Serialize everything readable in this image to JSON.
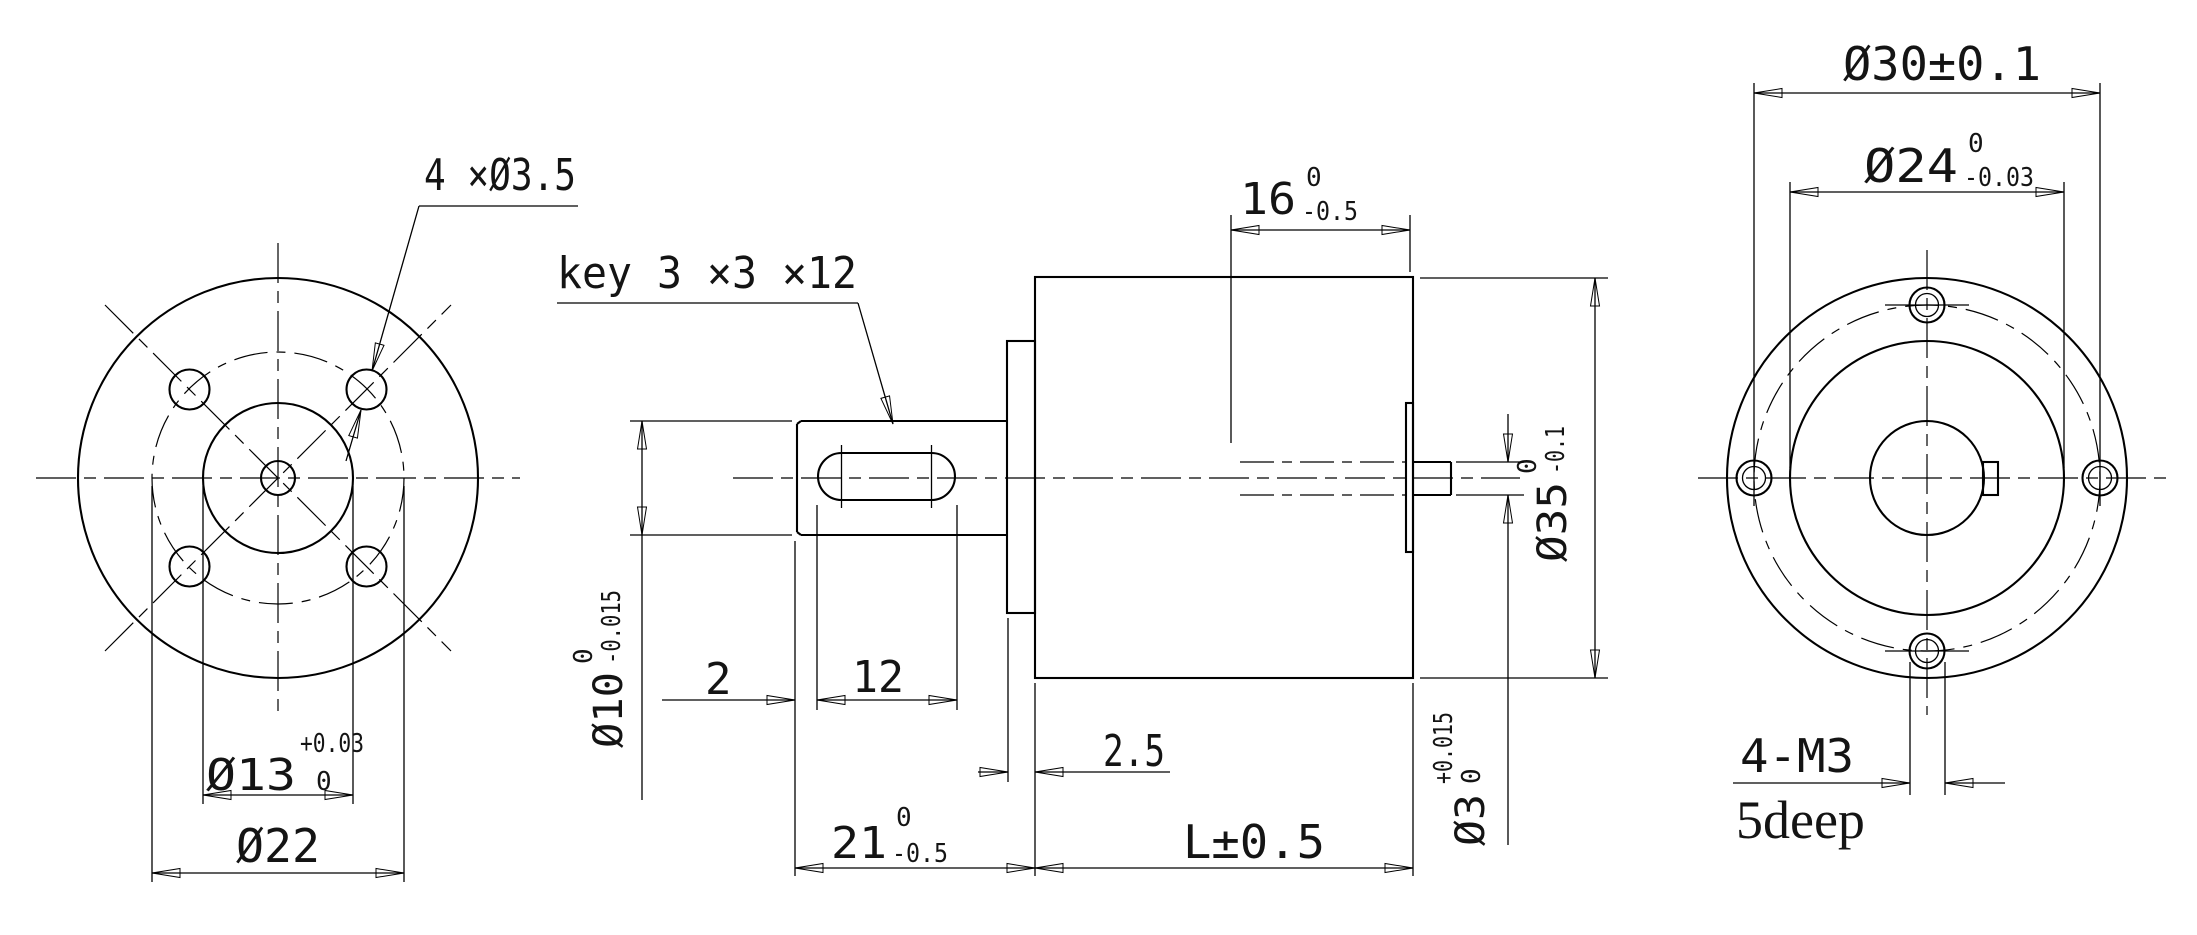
{
  "drawing": {
    "rear_view": {
      "hole_callout": "4 ×Ø3.5",
      "dim_d13": {
        "main": "Ø13",
        "tol_upper": "+0.03",
        "tol_lower": "0"
      },
      "dim_d22": {
        "main": "Ø22"
      }
    },
    "side_view": {
      "key_callout": "key 3 ×3 ×12",
      "dim_16": {
        "main": "16",
        "tol_upper": "0",
        "tol_lower": "-0.5"
      },
      "dim_d10": {
        "main": "Ø10",
        "tol_upper": "0",
        "tol_lower": "-0.015"
      },
      "dim_2": {
        "main": "2"
      },
      "dim_12": {
        "main": "12"
      },
      "dim_2_5": {
        "main": "2.5"
      },
      "dim_21": {
        "main": "21",
        "tol_upper": "0",
        "tol_lower": "-0.5"
      },
      "dim_L": {
        "main": "L±0.5"
      },
      "dim_d35": {
        "main": "Ø35",
        "tol_upper": "0",
        "tol_lower": "-0.1"
      },
      "dim_d3": {
        "main": "Ø3",
        "tol_upper": "+0.015",
        "tol_lower": "0"
      }
    },
    "front_view": {
      "dim_d30": {
        "main": "Ø30±0.1"
      },
      "dim_d24": {
        "main": "Ø24",
        "tol_upper": "0",
        "tol_lower": "-0.03"
      },
      "thread_callout": "4-M3",
      "depth_note": "5deep"
    },
    "colors": {
      "line": "#000000",
      "background": "#ffffff"
    }
  }
}
